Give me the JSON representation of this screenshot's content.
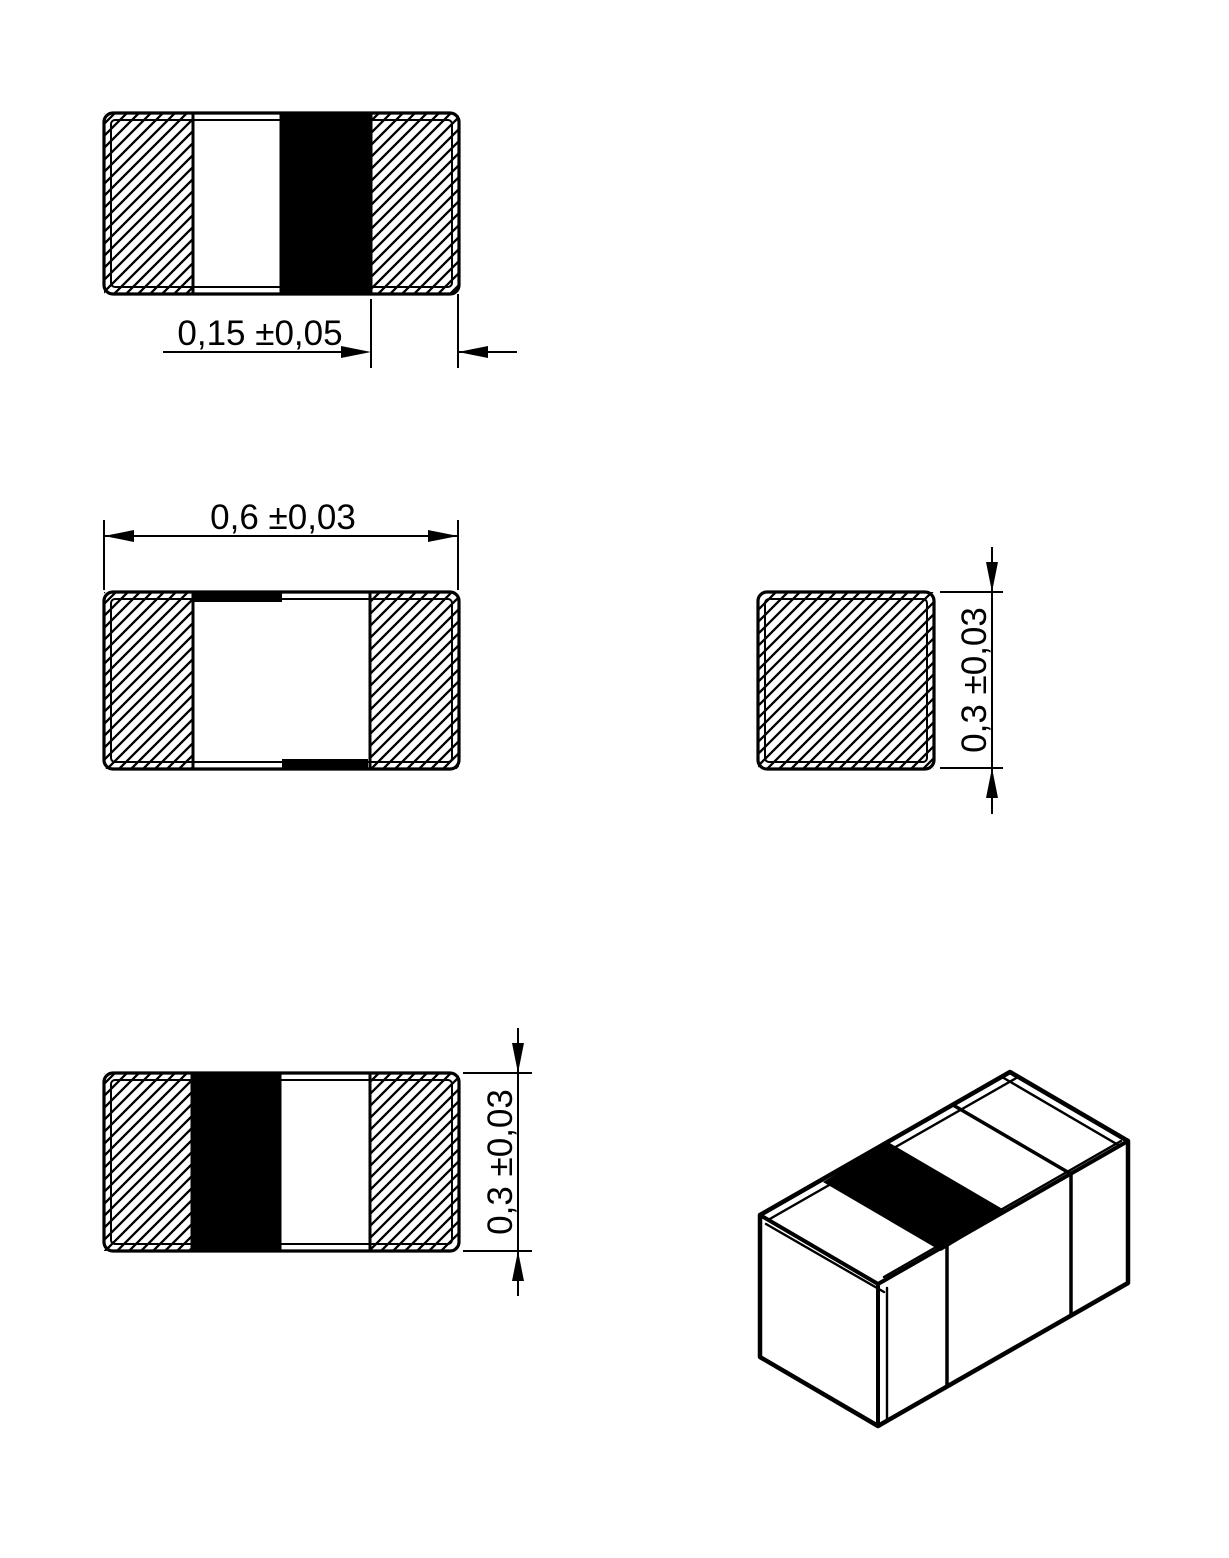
{
  "drawing": {
    "background_color": "#ffffff",
    "line_color": "#000000",
    "marking_band_color": "#000000",
    "dimensions": {
      "marking_offset": {
        "text": "0,15 ±0,05",
        "value": "0,15",
        "tolerance": "±0,05"
      },
      "length": {
        "text": "0,6 ±0,03",
        "value": "0,6",
        "tolerance": "±0,03"
      },
      "height_end": {
        "text": "0,3 ±0,03",
        "value": "0,3",
        "tolerance": "±0,03"
      },
      "height_front": {
        "text": "0,3 ±0,03",
        "value": "0,3",
        "tolerance": "±0,03"
      }
    }
  }
}
